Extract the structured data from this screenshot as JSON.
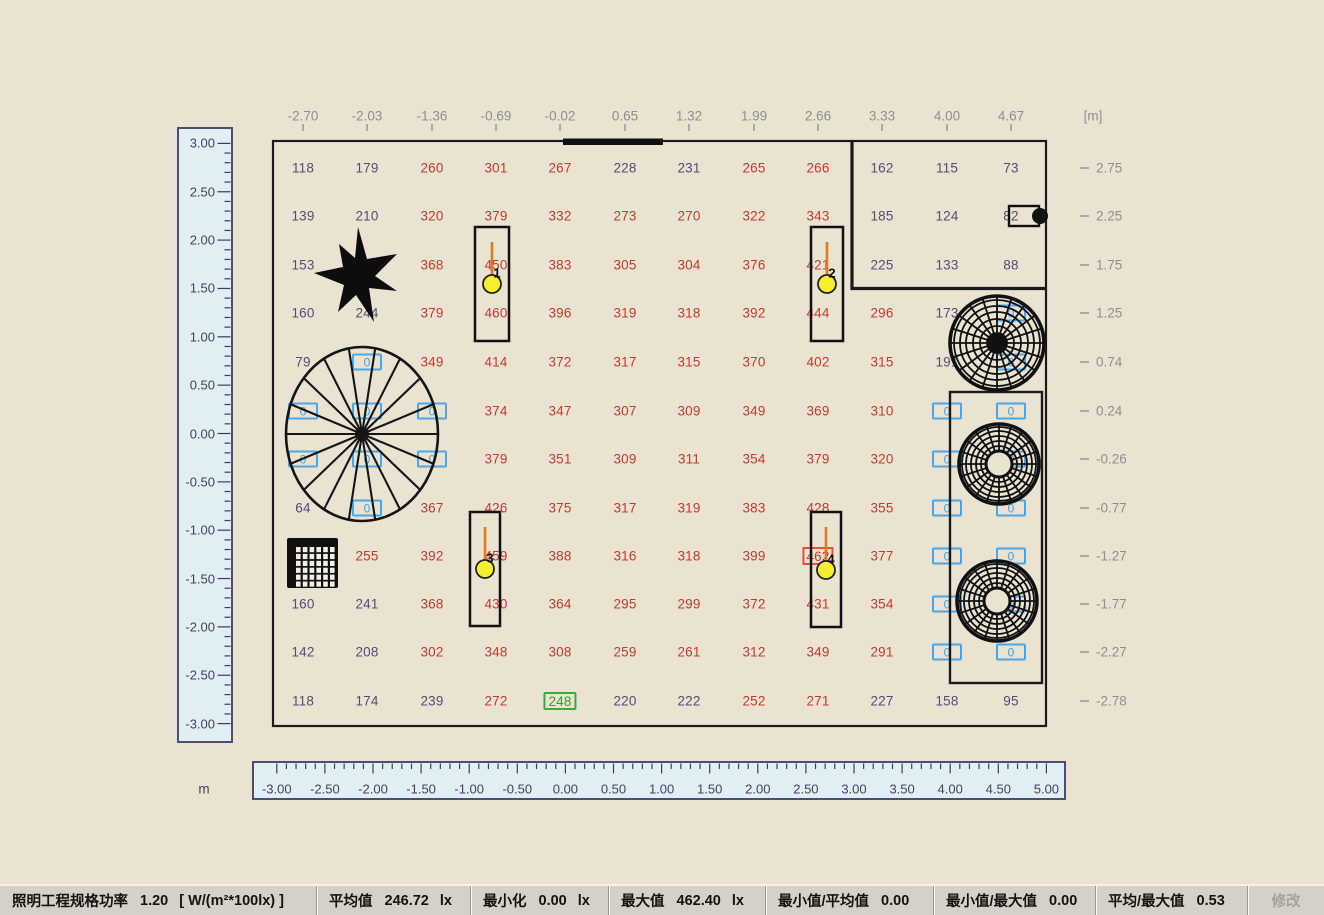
{
  "axes": {
    "top": [
      "-2.70",
      "-2.03",
      "-1.36",
      "-0.69",
      "-0.02",
      "0.65",
      "1.32",
      "1.99",
      "2.66",
      "3.33",
      "4.00",
      "4.67"
    ],
    "top_unit": "[m]",
    "right": [
      "2.75",
      "2.25",
      "1.75",
      "1.25",
      "0.74",
      "0.24",
      "-0.26",
      "-0.77",
      "-1.27",
      "-1.77",
      "-2.27",
      "-2.78"
    ]
  },
  "rulers": {
    "left": {
      "labels": [
        "3.00",
        "2.50",
        "2.00",
        "1.50",
        "1.00",
        "0.50",
        "0.00",
        "-0.50",
        "-1.00",
        "-1.50",
        "-2.00",
        "-2.50",
        "-3.00"
      ]
    },
    "bottom": {
      "labels": [
        "-3.00",
        "-2.50",
        "-2.00",
        "-1.50",
        "-1.00",
        "-0.50",
        "0.00",
        "0.50",
        "1.00",
        "1.50",
        "2.00",
        "2.50",
        "3.00",
        "3.50",
        "4.00",
        "4.50",
        "5.00"
      ],
      "unit": "m"
    }
  },
  "grid": {
    "legend": "each cell = value + style letter: p=purple normal, r=red lit, b=blue boxed zero point, g=green boxed (avg), m=red boxed maximum, e=hidden behind object",
    "rows": [
      {
        "y": "2.75",
        "cells": [
          "118p",
          "179p",
          "260r",
          "301r",
          "267r",
          "228p",
          "231p",
          "265r",
          "266r",
          "162p",
          "115p",
          "73p"
        ]
      },
      {
        "y": "2.25",
        "cells": [
          "139p",
          "210p",
          "320r",
          "379r",
          "332r",
          "273r",
          "270r",
          "322r",
          "343r",
          "185p",
          "124p",
          "82p"
        ]
      },
      {
        "y": "1.75",
        "cells": [
          "153p",
          "e",
          "368r",
          "450r",
          "383r",
          "305r",
          "304r",
          "376r",
          "421r",
          "225p",
          "133p",
          "88p"
        ]
      },
      {
        "y": "1.25",
        "cells": [
          "160p",
          "244p",
          "379r",
          "460r",
          "396r",
          "319r",
          "318r",
          "392r",
          "444r",
          "296r",
          "173p",
          "0b"
        ]
      },
      {
        "y": "0.74",
        "cells": [
          "79p",
          "0b",
          "349r",
          "414r",
          "372r",
          "317r",
          "315r",
          "370r",
          "402r",
          "315r",
          "191p",
          "0b"
        ]
      },
      {
        "y": "0.24",
        "cells": [
          "0b",
          "0b",
          "0b",
          "374r",
          "347r",
          "307r",
          "309r",
          "349r",
          "369r",
          "310r",
          "0b",
          "0b"
        ]
      },
      {
        "y": "-0.26",
        "cells": [
          "0b",
          "0b",
          "0b",
          "379r",
          "351r",
          "309r",
          "311r",
          "354r",
          "379r",
          "320r",
          "0b",
          "0b"
        ]
      },
      {
        "y": "-0.77",
        "cells": [
          "64p",
          "0b",
          "367r",
          "426r",
          "375r",
          "317r",
          "319r",
          "383r",
          "428r",
          "355r",
          "0b",
          "0b"
        ]
      },
      {
        "y": "-1.27",
        "cells": [
          "e",
          "255r",
          "392r",
          "459r",
          "388r",
          "316r",
          "318r",
          "399r",
          "462m",
          "377r",
          "0b",
          "0b"
        ]
      },
      {
        "y": "-1.77",
        "cells": [
          "160p",
          "241p",
          "368r",
          "430r",
          "364r",
          "295r",
          "299r",
          "372r",
          "431r",
          "354r",
          "0b",
          "0b"
        ]
      },
      {
        "y": "-2.27",
        "cells": [
          "142p",
          "208p",
          "302r",
          "348r",
          "308r",
          "259r",
          "261r",
          "312r",
          "349r",
          "291r",
          "0b",
          "0b"
        ]
      },
      {
        "y": "-2.78",
        "cells": [
          "118p",
          "174p",
          "239p",
          "272r",
          "248g",
          "220p",
          "222p",
          "252r",
          "271r",
          "227p",
          "158p",
          "95p"
        ]
      }
    ]
  },
  "objects": {
    "lamps": [
      {
        "id": "1"
      },
      {
        "id": "2"
      },
      {
        "id": "3"
      },
      {
        "id": "4"
      }
    ],
    "symbols": {
      "plant": "plant-icon",
      "spiral_staircase": "spiral-staircase-icon",
      "floor_grate": "grate-icon",
      "dome_fan": "dome-fan-icon",
      "ring_fan": "ring-fan-icon",
      "door": "door-icon",
      "luminaire": "luminaire-icon"
    }
  },
  "status_bar": {
    "segments": [
      {
        "label": "照明工程规格功率",
        "value": "1.20",
        "unit": "[ W/(m²*100lx) ]"
      },
      {
        "label": "平均值",
        "value": "246.72",
        "unit": "lx"
      },
      {
        "label": "最小化",
        "value": "0.00",
        "unit": "lx"
      },
      {
        "label": "最大值",
        "value": "462.40",
        "unit": "lx"
      },
      {
        "label": "最小值/平均值",
        "value": "0.00",
        "unit": ""
      },
      {
        "label": "最小值/最大值",
        "value": "0.00",
        "unit": ""
      },
      {
        "label": "平均/最大值",
        "value": "0.53",
        "unit": ""
      }
    ],
    "edit_button": "修改"
  },
  "colors": {
    "canvas_bg": "#ebe3d2",
    "ruler_bg": "#e0eff3",
    "statusbar_bg": "#d5d1c8",
    "value_normal": "#564a74",
    "value_lit": "#bf3a30",
    "value_zero": "#3f9fe0",
    "value_avg_green": "#2f9f2f",
    "max_box_red": "#e8503a",
    "lamp_yellow": "#f5ef2e",
    "lamp_line_orange": "#e07a20",
    "wall": "#1a1a1a"
  }
}
